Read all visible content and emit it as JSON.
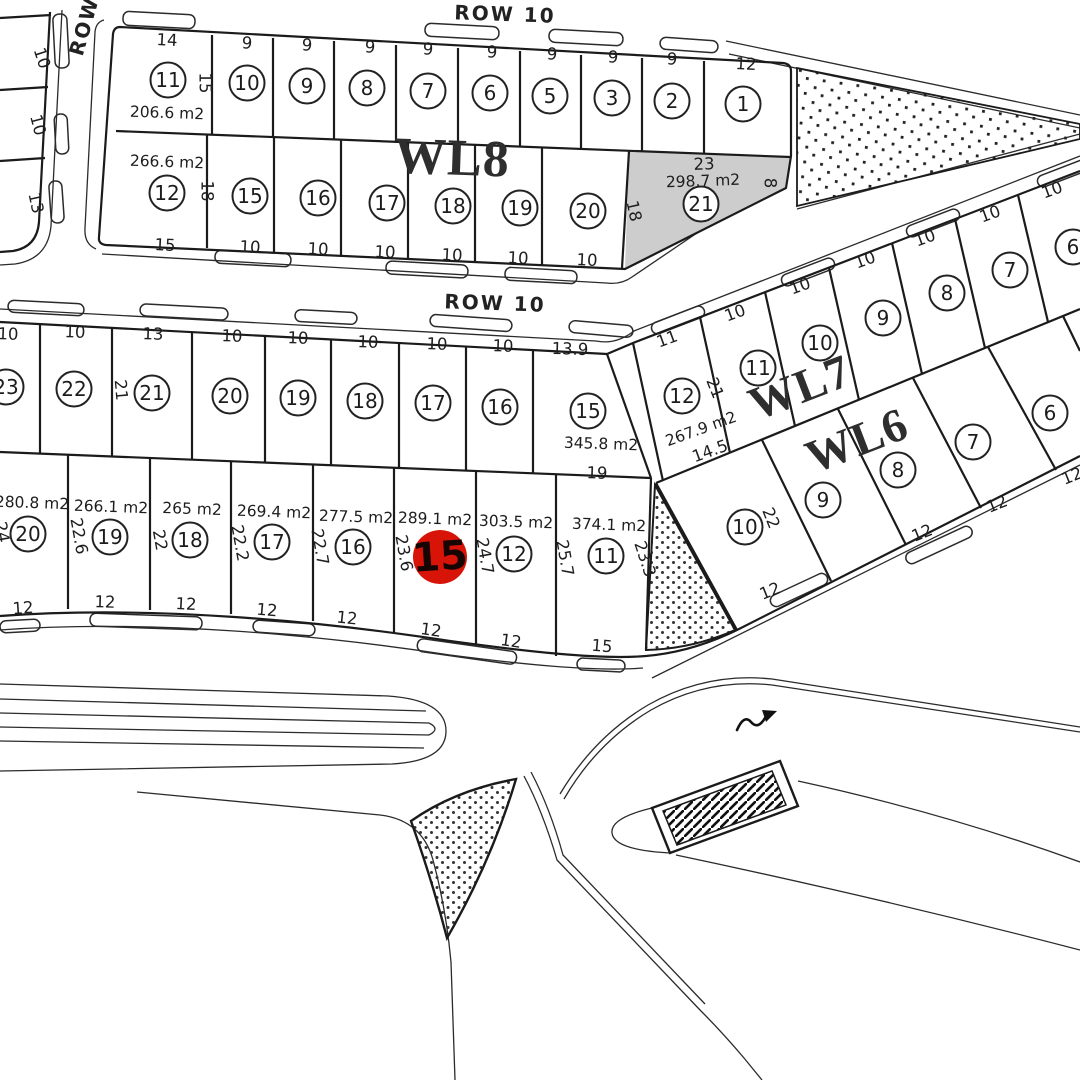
{
  "colors": {
    "background": "#ffffff",
    "line": "#1b1b1b",
    "curb": "#2b2b2b",
    "shaded_plot_fill": "#cdcdcd",
    "highlight_fill": "#d81408",
    "highlight_text": "#170503"
  },
  "badge_style": {
    "radius": 17.5,
    "fill": "#ffffff",
    "stroke": "#222222"
  },
  "streets": [
    {
      "text": "ROW 10",
      "x": 505,
      "y": 14,
      "rot": 2
    },
    {
      "text": "ROW 10",
      "x": 495,
      "y": 303,
      "rot": 2
    },
    {
      "text": "ROW",
      "x": 84,
      "y": 26,
      "rot": -74
    }
  ],
  "block_labels": [
    {
      "text": "WL8",
      "x": 452,
      "y": 158,
      "rot": 2,
      "size": 52
    },
    {
      "text": "WL7",
      "x": 800,
      "y": 388,
      "rot": -21,
      "size": 47
    },
    {
      "text": "WL6",
      "x": 857,
      "y": 441,
      "rot": -21,
      "size": 47
    }
  ],
  "highlight_badge": {
    "n": "15",
    "x": 440,
    "y": 557,
    "r": 27,
    "rot": -4,
    "area": "289.1 m2"
  },
  "shaded_plot": {
    "n": "21",
    "area": "298.7 m2",
    "top_dim": "23"
  },
  "plot_badges": [
    {
      "n": "11",
      "x": 168,
      "y": 80
    },
    {
      "n": "10",
      "x": 247,
      "y": 83
    },
    {
      "n": "9",
      "x": 307,
      "y": 86
    },
    {
      "n": "8",
      "x": 367,
      "y": 88
    },
    {
      "n": "7",
      "x": 428,
      "y": 91
    },
    {
      "n": "6",
      "x": 490,
      "y": 93
    },
    {
      "n": "5",
      "x": 550,
      "y": 96
    },
    {
      "n": "3",
      "x": 612,
      "y": 98
    },
    {
      "n": "2",
      "x": 672,
      "y": 101
    },
    {
      "n": "1",
      "x": 743,
      "y": 104
    },
    {
      "n": "12",
      "x": 167,
      "y": 193
    },
    {
      "n": "15",
      "x": 250,
      "y": 196
    },
    {
      "n": "16",
      "x": 318,
      "y": 198
    },
    {
      "n": "17",
      "x": 387,
      "y": 203
    },
    {
      "n": "18",
      "x": 453,
      "y": 206
    },
    {
      "n": "19",
      "x": 520,
      "y": 208
    },
    {
      "n": "20",
      "x": 588,
      "y": 211
    },
    {
      "n": "21",
      "x": 701,
      "y": 204
    },
    {
      "n": "23",
      "x": 6,
      "y": 387
    },
    {
      "n": "22",
      "x": 74,
      "y": 389
    },
    {
      "n": "21",
      "x": 152,
      "y": 393
    },
    {
      "n": "20",
      "x": 230,
      "y": 396
    },
    {
      "n": "19",
      "x": 298,
      "y": 398
    },
    {
      "n": "18",
      "x": 365,
      "y": 401
    },
    {
      "n": "17",
      "x": 433,
      "y": 403
    },
    {
      "n": "16",
      "x": 500,
      "y": 407
    },
    {
      "n": "15",
      "x": 588,
      "y": 411
    },
    {
      "n": "20",
      "x": 28,
      "y": 534
    },
    {
      "n": "19",
      "x": 110,
      "y": 537
    },
    {
      "n": "18",
      "x": 190,
      "y": 540
    },
    {
      "n": "17",
      "x": 272,
      "y": 542
    },
    {
      "n": "16",
      "x": 353,
      "y": 547
    },
    {
      "n": "12",
      "x": 514,
      "y": 554
    },
    {
      "n": "11",
      "x": 606,
      "y": 556
    },
    {
      "n": "12",
      "x": 682,
      "y": 396
    },
    {
      "n": "11",
      "x": 758,
      "y": 368
    },
    {
      "n": "10",
      "x": 820,
      "y": 343
    },
    {
      "n": "9",
      "x": 883,
      "y": 318
    },
    {
      "n": "8",
      "x": 947,
      "y": 293
    },
    {
      "n": "7",
      "x": 1010,
      "y": 270
    },
    {
      "n": "6",
      "x": 1073,
      "y": 247
    },
    {
      "n": "10",
      "x": 745,
      "y": 527
    },
    {
      "n": "9",
      "x": 823,
      "y": 500
    },
    {
      "n": "8",
      "x": 898,
      "y": 470
    },
    {
      "n": "7",
      "x": 973,
      "y": 442
    },
    {
      "n": "6",
      "x": 1050,
      "y": 413
    }
  ],
  "dim_labels": [
    {
      "t": "14",
      "x": 167,
      "y": 40,
      "r": 3
    },
    {
      "t": "9",
      "x": 247,
      "y": 43,
      "r": 3
    },
    {
      "t": "9",
      "x": 307,
      "y": 45,
      "r": 3
    },
    {
      "t": "9",
      "x": 370,
      "y": 47,
      "r": 3
    },
    {
      "t": "9",
      "x": 428,
      "y": 49,
      "r": 3
    },
    {
      "t": "9",
      "x": 492,
      "y": 52,
      "r": 3
    },
    {
      "t": "9",
      "x": 552,
      "y": 54,
      "r": 3
    },
    {
      "t": "9",
      "x": 613,
      "y": 57,
      "r": 3
    },
    {
      "t": "9",
      "x": 672,
      "y": 59,
      "r": 3
    },
    {
      "t": "12",
      "x": 746,
      "y": 64,
      "r": 3
    },
    {
      "t": "15",
      "x": 205,
      "y": 83,
      "r": 90
    },
    {
      "t": "18",
      "x": 207,
      "y": 191,
      "r": 90
    },
    {
      "t": "15",
      "x": 165,
      "y": 245,
      "r": 3
    },
    {
      "t": "10",
      "x": 250,
      "y": 247,
      "r": 3
    },
    {
      "t": "10",
      "x": 318,
      "y": 249,
      "r": 3
    },
    {
      "t": "10",
      "x": 385,
      "y": 252,
      "r": 3
    },
    {
      "t": "10",
      "x": 452,
      "y": 255,
      "r": 3
    },
    {
      "t": "10",
      "x": 518,
      "y": 258,
      "r": 3
    },
    {
      "t": "10",
      "x": 587,
      "y": 260,
      "r": 3
    },
    {
      "t": "23",
      "x": 704,
      "y": 164,
      "r": -2
    },
    {
      "t": "18",
      "x": 634,
      "y": 211,
      "r": 78
    },
    {
      "t": "8",
      "x": 770,
      "y": 183,
      "r": 90
    },
    {
      "t": "10",
      "x": 8,
      "y": 334,
      "r": 2
    },
    {
      "t": "10",
      "x": 75,
      "y": 332,
      "r": 2
    },
    {
      "t": "13",
      "x": 153,
      "y": 334,
      "r": 2
    },
    {
      "t": "10",
      "x": 232,
      "y": 336,
      "r": 2
    },
    {
      "t": "10",
      "x": 298,
      "y": 338,
      "r": 2
    },
    {
      "t": "10",
      "x": 368,
      "y": 342,
      "r": 2
    },
    {
      "t": "10",
      "x": 437,
      "y": 344,
      "r": 2
    },
    {
      "t": "10",
      "x": 503,
      "y": 346,
      "r": 2
    },
    {
      "t": "13.9",
      "x": 570,
      "y": 349,
      "r": 2
    },
    {
      "t": "21",
      "x": 121,
      "y": 390,
      "r": 85
    },
    {
      "t": "19",
      "x": 597,
      "y": 473,
      "r": 2
    },
    {
      "t": "24",
      "x": 2,
      "y": 532,
      "r": 80
    },
    {
      "t": "22.6",
      "x": 79,
      "y": 536,
      "r": 80
    },
    {
      "t": "22",
      "x": 160,
      "y": 540,
      "r": 80
    },
    {
      "t": "22.2",
      "x": 240,
      "y": 543,
      "r": 80
    },
    {
      "t": "22.7",
      "x": 320,
      "y": 547,
      "r": 80
    },
    {
      "t": "23.6",
      "x": 404,
      "y": 553,
      "r": 80
    },
    {
      "t": "24.7",
      "x": 485,
      "y": 556,
      "r": 80
    },
    {
      "t": "25.7",
      "x": 565,
      "y": 558,
      "r": 80
    },
    {
      "t": "23.3",
      "x": 645,
      "y": 559,
      "r": 72
    },
    {
      "t": "12",
      "x": 23,
      "y": 608,
      "r": -4
    },
    {
      "t": "12",
      "x": 105,
      "y": 602,
      "r": 2
    },
    {
      "t": "12",
      "x": 186,
      "y": 604,
      "r": 3
    },
    {
      "t": "12",
      "x": 267,
      "y": 610,
      "r": 5
    },
    {
      "t": "12",
      "x": 347,
      "y": 618,
      "r": 6
    },
    {
      "t": "12",
      "x": 431,
      "y": 630,
      "r": 8
    },
    {
      "t": "12",
      "x": 511,
      "y": 641,
      "r": 8
    },
    {
      "t": "15",
      "x": 602,
      "y": 646,
      "r": 5
    },
    {
      "t": "11",
      "x": 667,
      "y": 339,
      "r": -20
    },
    {
      "t": "10",
      "x": 735,
      "y": 313,
      "r": -20
    },
    {
      "t": "10",
      "x": 800,
      "y": 286,
      "r": -20
    },
    {
      "t": "10",
      "x": 865,
      "y": 260,
      "r": -20
    },
    {
      "t": "10",
      "x": 925,
      "y": 238,
      "r": -20
    },
    {
      "t": "10",
      "x": 990,
      "y": 214,
      "r": -20
    },
    {
      "t": "10",
      "x": 1052,
      "y": 190,
      "r": -20
    },
    {
      "t": "21",
      "x": 715,
      "y": 388,
      "r": 68
    },
    {
      "t": "14.5",
      "x": 710,
      "y": 451,
      "r": -20
    },
    {
      "t": "22",
      "x": 771,
      "y": 518,
      "r": 68
    },
    {
      "t": "12",
      "x": 770,
      "y": 591,
      "r": -22
    },
    {
      "t": "12",
      "x": 922,
      "y": 533,
      "r": -22
    },
    {
      "t": "12",
      "x": 997,
      "y": 504,
      "r": -22
    },
    {
      "t": "12",
      "x": 1072,
      "y": 476,
      "r": -22
    },
    {
      "t": "10",
      "x": 42,
      "y": 58,
      "r": 72
    },
    {
      "t": "10",
      "x": 38,
      "y": 125,
      "r": 75
    },
    {
      "t": "13",
      "x": 36,
      "y": 203,
      "r": 78
    }
  ],
  "area_labels": [
    {
      "t": "206.6 m2",
      "x": 167,
      "y": 113,
      "r": 2
    },
    {
      "t": "266.6 m2",
      "x": 167,
      "y": 162,
      "r": 2
    },
    {
      "t": "298.7 m2",
      "x": 703,
      "y": 181,
      "r": -2
    },
    {
      "t": "345.8 m2",
      "x": 601,
      "y": 444,
      "r": 2
    },
    {
      "t": "280.8 m2",
      "x": 32,
      "y": 503,
      "r": 2
    },
    {
      "t": "266.1 m2",
      "x": 111,
      "y": 507,
      "r": 2
    },
    {
      "t": "265 m2",
      "x": 192,
      "y": 509,
      "r": 2
    },
    {
      "t": "269.4 m2",
      "x": 274,
      "y": 512,
      "r": 2
    },
    {
      "t": "277.5 m2",
      "x": 356,
      "y": 517,
      "r": 2
    },
    {
      "t": "289.1 m2",
      "x": 435,
      "y": 519,
      "r": 2
    },
    {
      "t": "303.5 m2",
      "x": 516,
      "y": 522,
      "r": 2
    },
    {
      "t": "374.1 m2",
      "x": 609,
      "y": 525,
      "r": 2
    },
    {
      "t": "267.9 m2",
      "x": 701,
      "y": 429,
      "r": -20
    }
  ]
}
